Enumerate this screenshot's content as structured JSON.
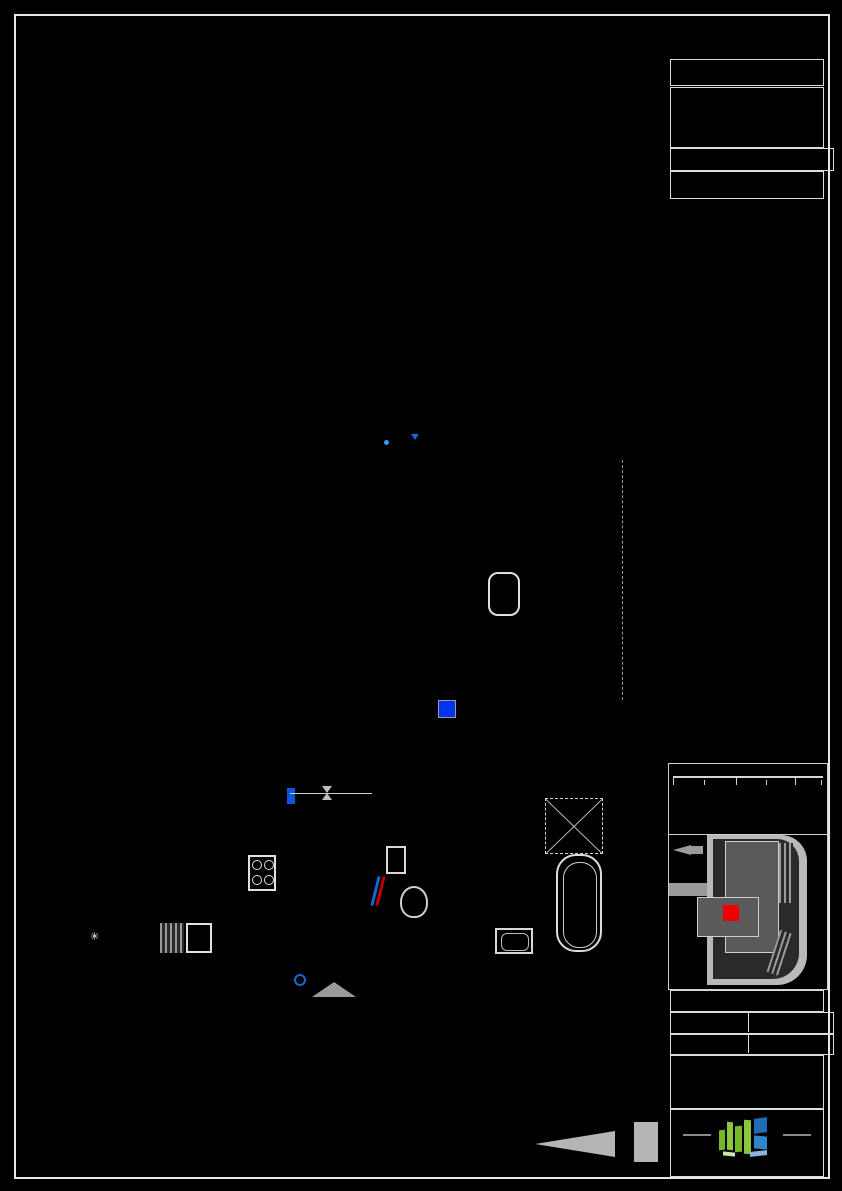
{
  "colors": {
    "wall": "#ff0000",
    "insulation": "#ffa500",
    "light_yellow": "#ffff00",
    "outlet_red": "#c40000",
    "window_green": "#35c435",
    "symbol_blue": "#1565d8",
    "teal": "#57c7a2",
    "panel_blue": "#0033ee",
    "logo_green": "#76b82a",
    "logo_blue": "#1f6cb4",
    "logo_lightblue": "#8ab4d8",
    "unit_red": "#ee0000"
  },
  "title_block": {
    "projekt_label": "PROJEKT",
    "project_name_line1": "WOHNEN IN",
    "project_name_line2": "ALKOVEN",
    "objekt_label": "OBJEKT Nr.",
    "objekt_nr": "1299",
    "top_label": "TOP 139",
    "areas": [
      {
        "label": "Wohnräume",
        "value": "73,83 m²",
        "bold": false
      },
      {
        "label": "SUMME",
        "value": "73,83 m²",
        "bold": true
      },
      {
        "label": "Balkon",
        "value": "8,00 m²",
        "bold": false
      },
      {
        "label": "Keller",
        "value": "4,10 m²",
        "bold": false
      }
    ],
    "scale": {
      "tick0": "0",
      "tick1": "1",
      "tick2": "2m",
      "line1": "MASSSTAB 1:50 BEI AUSDRUCK IN",
      "line2": "ORIGINALGRÖSSE",
      "line3": "RAUMHÖHE= 2,58 m"
    },
    "plan_type": "VERTRIEBSPLAN",
    "geschoss_label": "GESCHOSS",
    "geschoss_value": "2.OG",
    "datum_label": "DATUM",
    "datum_value": "25.02.2025",
    "unterschrift_label": "UNTERSCHRIFT",
    "logo_text": "OÖWOHNBAU",
    "compass_letter": "N"
  },
  "plan": {
    "entrance_label": "TOP 139",
    "walls": [
      {
        "x": 65,
        "y": 459,
        "w": 554,
        "h": 13
      },
      {
        "x": 65,
        "y": 459,
        "w": 13,
        "h": 501
      },
      {
        "x": 606,
        "y": 448,
        "w": 13,
        "h": 512
      },
      {
        "x": 65,
        "y": 948,
        "w": 240,
        "h": 14
      },
      {
        "x": 377,
        "y": 948,
        "w": 229,
        "h": 14
      },
      {
        "x": 279,
        "y": 472,
        "w": 12,
        "h": 253
      },
      {
        "x": 279,
        "y": 777,
        "w": 12,
        "h": 171
      },
      {
        "x": 441,
        "y": 472,
        "w": 12,
        "h": 225
      },
      {
        "x": 372,
        "y": 801,
        "w": 10,
        "h": 147
      },
      {
        "x": 416,
        "y": 792,
        "w": 30,
        "h": 9
      },
      {
        "x": 505,
        "y": 790,
        "w": 101,
        "h": 11
      }
    ],
    "orange": [
      {
        "x": 60,
        "y": 448,
        "w": 559,
        "h": 11
      },
      {
        "x": 60,
        "y": 459,
        "w": 5,
        "h": 501
      },
      {
        "x": 65,
        "y": 962,
        "w": 240,
        "h": 6
      },
      {
        "x": 377,
        "y": 962,
        "w": 229,
        "h": 6
      },
      {
        "x": 601,
        "y": 453,
        "w": 5,
        "h": 247
      },
      {
        "x": 445,
        "y": 801,
        "w": 9,
        "h": 147
      }
    ],
    "whites": [
      {
        "x": 305,
        "y": 948,
        "w": 5,
        "h": 14
      },
      {
        "x": 372,
        "y": 948,
        "w": 5,
        "h": 14
      },
      {
        "x": 279,
        "y": 720,
        "w": 12,
        "h": 5
      },
      {
        "x": 279,
        "y": 777,
        "w": 12,
        "h": 5
      },
      {
        "x": 441,
        "y": 692,
        "w": 12,
        "h": 5
      },
      {
        "x": 497,
        "y": 790,
        "w": 6,
        "h": 11
      },
      {
        "x": 448,
        "y": 790,
        "w": 6,
        "h": 11
      },
      {
        "x": 372,
        "y": 792,
        "w": 7,
        "h": 9
      },
      {
        "x": 408,
        "y": 792,
        "w": 6,
        "h": 9
      }
    ],
    "windows": [
      {
        "x": 83,
        "y": 450,
        "w": 54,
        "h": 22
      },
      {
        "x": 162,
        "y": 450,
        "w": 73,
        "h": 22
      },
      {
        "x": 295,
        "y": 450,
        "w": 60,
        "h": 22
      },
      {
        "x": 458,
        "y": 450,
        "w": 64,
        "h": 22
      }
    ],
    "overlays": [
      {
        "x": 247,
        "y": 446,
        "w": 31,
        "h": 32
      },
      {
        "x": 404,
        "y": 446,
        "w": 33,
        "h": 32
      }
    ],
    "grid": {
      "x": 148,
      "y": 340,
      "w": 212,
      "h": 108
    },
    "dashed": [
      {
        "x": 88,
        "y": 480,
        "w": 158,
        "h": 64
      },
      {
        "x": 88,
        "y": 546,
        "w": 38,
        "h": 108
      },
      {
        "x": 258,
        "y": 492,
        "w": 18,
        "h": 148
      },
      {
        "x": 72,
        "y": 707,
        "w": 102,
        "h": 42
      },
      {
        "x": 90,
        "y": 757,
        "w": 22,
        "h": 28
      },
      {
        "x": 127,
        "y": 757,
        "w": 22,
        "h": 28
      },
      {
        "x": 160,
        "y": 757,
        "w": 22,
        "h": 28
      },
      {
        "x": 75,
        "y": 814,
        "w": 100,
        "h": 56
      },
      {
        "x": 77,
        "y": 862,
        "w": 201,
        "h": 84
      },
      {
        "x": 302,
        "y": 540,
        "w": 112,
        "h": 120,
        "thick": true
      },
      {
        "x": 292,
        "y": 506,
        "w": 26,
        "h": 34
      },
      {
        "x": 292,
        "y": 662,
        "w": 26,
        "h": 34
      },
      {
        "x": 358,
        "y": 489,
        "w": 82,
        "h": 20
      },
      {
        "x": 408,
        "y": 514,
        "w": 26,
        "h": 92
      },
      {
        "x": 455,
        "y": 545,
        "w": 46,
        "h": 90
      },
      {
        "x": 552,
        "y": 485,
        "w": 52,
        "h": 154,
        "thick": true
      },
      {
        "x": 524,
        "y": 488,
        "w": 30,
        "h": 29
      },
      {
        "x": 570,
        "y": 645,
        "w": 42,
        "h": 80
      },
      {
        "x": 290,
        "y": 726,
        "w": 92,
        "h": 38
      },
      {
        "x": 302,
        "y": 810,
        "w": 12,
        "h": 132,
        "thick": true
      },
      {
        "x": 452,
        "y": 922,
        "w": 36,
        "h": 36
      }
    ],
    "lights": [
      {
        "x": 180,
        "y": 592,
        "d": 30
      },
      {
        "x": 362,
        "y": 600,
        "d": 30
      },
      {
        "x": 530,
        "y": 598,
        "d": 30
      },
      {
        "x": 125,
        "y": 722,
        "d": 30
      },
      {
        "x": 395,
        "y": 758,
        "d": 30
      },
      {
        "x": 160,
        "y": 886,
        "d": 30
      },
      {
        "x": 334,
        "y": 875,
        "d": 30
      },
      {
        "x": 417,
        "y": 875,
        "d": 24
      },
      {
        "x": 527,
        "y": 875,
        "d": 26
      },
      {
        "x": 183,
        "y": 948,
        "d": 17
      },
      {
        "x": 260,
        "y": 397,
        "d": 10,
        "plain": true
      }
    ],
    "outlets": [
      {
        "x": 88,
        "y": 500,
        "r": 90
      },
      {
        "x": 82,
        "y": 553,
        "r": 90
      },
      {
        "x": 82,
        "y": 627,
        "r": 90
      },
      {
        "x": 88,
        "y": 728,
        "r": 90
      },
      {
        "x": 112,
        "y": 944,
        "r": 0
      },
      {
        "x": 148,
        "y": 944,
        "r": 0
      },
      {
        "x": 205,
        "y": 944,
        "r": 0
      },
      {
        "x": 232,
        "y": 944,
        "r": 0
      },
      {
        "x": 262,
        "y": 862,
        "r": 0
      },
      {
        "x": 268,
        "y": 876,
        "r": 90
      },
      {
        "x": 298,
        "y": 548,
        "r": -90
      },
      {
        "x": 298,
        "y": 656,
        "r": -90
      },
      {
        "x": 382,
        "y": 744,
        "r": -90
      },
      {
        "x": 452,
        "y": 588,
        "r": 90
      },
      {
        "x": 543,
        "y": 498,
        "r": 0
      },
      {
        "x": 528,
        "y": 788,
        "r": 0
      },
      {
        "x": 468,
        "y": 948,
        "r": 0
      },
      {
        "x": 490,
        "y": 944,
        "r": 0
      },
      {
        "x": 512,
        "y": 944,
        "r": 0
      },
      {
        "x": 540,
        "y": 942,
        "r": 0
      },
      {
        "x": 625,
        "y": 560,
        "r": 90
      }
    ],
    "greens": [
      {
        "x": 118,
        "y": 462
      },
      {
        "x": 220,
        "y": 462
      },
      {
        "x": 342,
        "y": 462
      },
      {
        "x": 512,
        "y": 462
      },
      {
        "x": 613,
        "y": 462
      }
    ],
    "ysyms": [
      {
        "x": 240,
        "y": 498,
        "r": 20
      },
      {
        "x": 368,
        "y": 494,
        "r": -30
      },
      {
        "x": 390,
        "y": 818,
        "r": 0
      },
      {
        "x": 505,
        "y": 814,
        "r": 40
      },
      {
        "x": 237,
        "y": 796,
        "r": 70
      },
      {
        "x": 254,
        "y": 803,
        "r": -20
      },
      {
        "x": 527,
        "y": 766,
        "r": 0
      },
      {
        "x": 262,
        "y": 440,
        "r": 0
      }
    ],
    "ycrosses": [
      {
        "x": 543,
        "y": 878
      },
      {
        "x": 566,
        "y": 878
      },
      {
        "x": 413,
        "y": 888
      }
    ],
    "labels": [
      {
        "t": "GELÄNDER H= 102cm",
        "x": 215,
        "y": 327,
        "s": 6.5,
        "c": "#d5d5d5"
      },
      {
        "t": "GELÄNDER H= 102cm",
        "x": 134,
        "y": 432,
        "s": 6.5,
        "c": "#d5d5d5",
        "r": -90
      },
      {
        "t": "GELÄNDER H= 102cm",
        "x": 386,
        "y": 432,
        "s": 6.5,
        "c": "#d5d5d5",
        "r": -90
      },
      {
        "t": "RB",
        "x": 392,
        "y": 437,
        "s": 7.5,
        "c": "#2e9bff",
        "b": true
      },
      {
        "t": "PARKETT",
        "x": 300,
        "y": 780,
        "s": 7,
        "c": "#d0d0d0"
      },
      {
        "t": "FLIESEN",
        "x": 302,
        "y": 796,
        "s": 7,
        "c": "#d0d0d0"
      },
      {
        "t": "VSS 50",
        "x": 68,
        "y": 630,
        "s": 6,
        "c": "#bdbdbd",
        "r": -90
      },
      {
        "t": "VSS 50",
        "x": 594,
        "y": 590,
        "s": 6,
        "c": "#bdbdbd",
        "r": -90
      },
      {
        "t": "VSS 50",
        "x": 594,
        "y": 770,
        "s": 6,
        "c": "#bdbdbd",
        "r": -90
      },
      {
        "t": "EU-OPTIONAL",
        "x": 547,
        "y": 799,
        "s": 5.5,
        "c": "#dddddd"
      },
      {
        "t": "WM",
        "x": 460,
        "y": 930,
        "s": 8,
        "c": "#cccccc"
      },
      {
        "t": "VM ROK=+1,17",
        "x": 388,
        "y": 920,
        "s": 6,
        "c": "#bbbbbb",
        "box": true
      },
      {
        "t": "TOP 139",
        "x": 320,
        "y": 998,
        "s": 8,
        "c": "#999999"
      }
    ],
    "teal_circle": {
      "cx": 450,
      "cy": 855,
      "r": 42
    }
  }
}
